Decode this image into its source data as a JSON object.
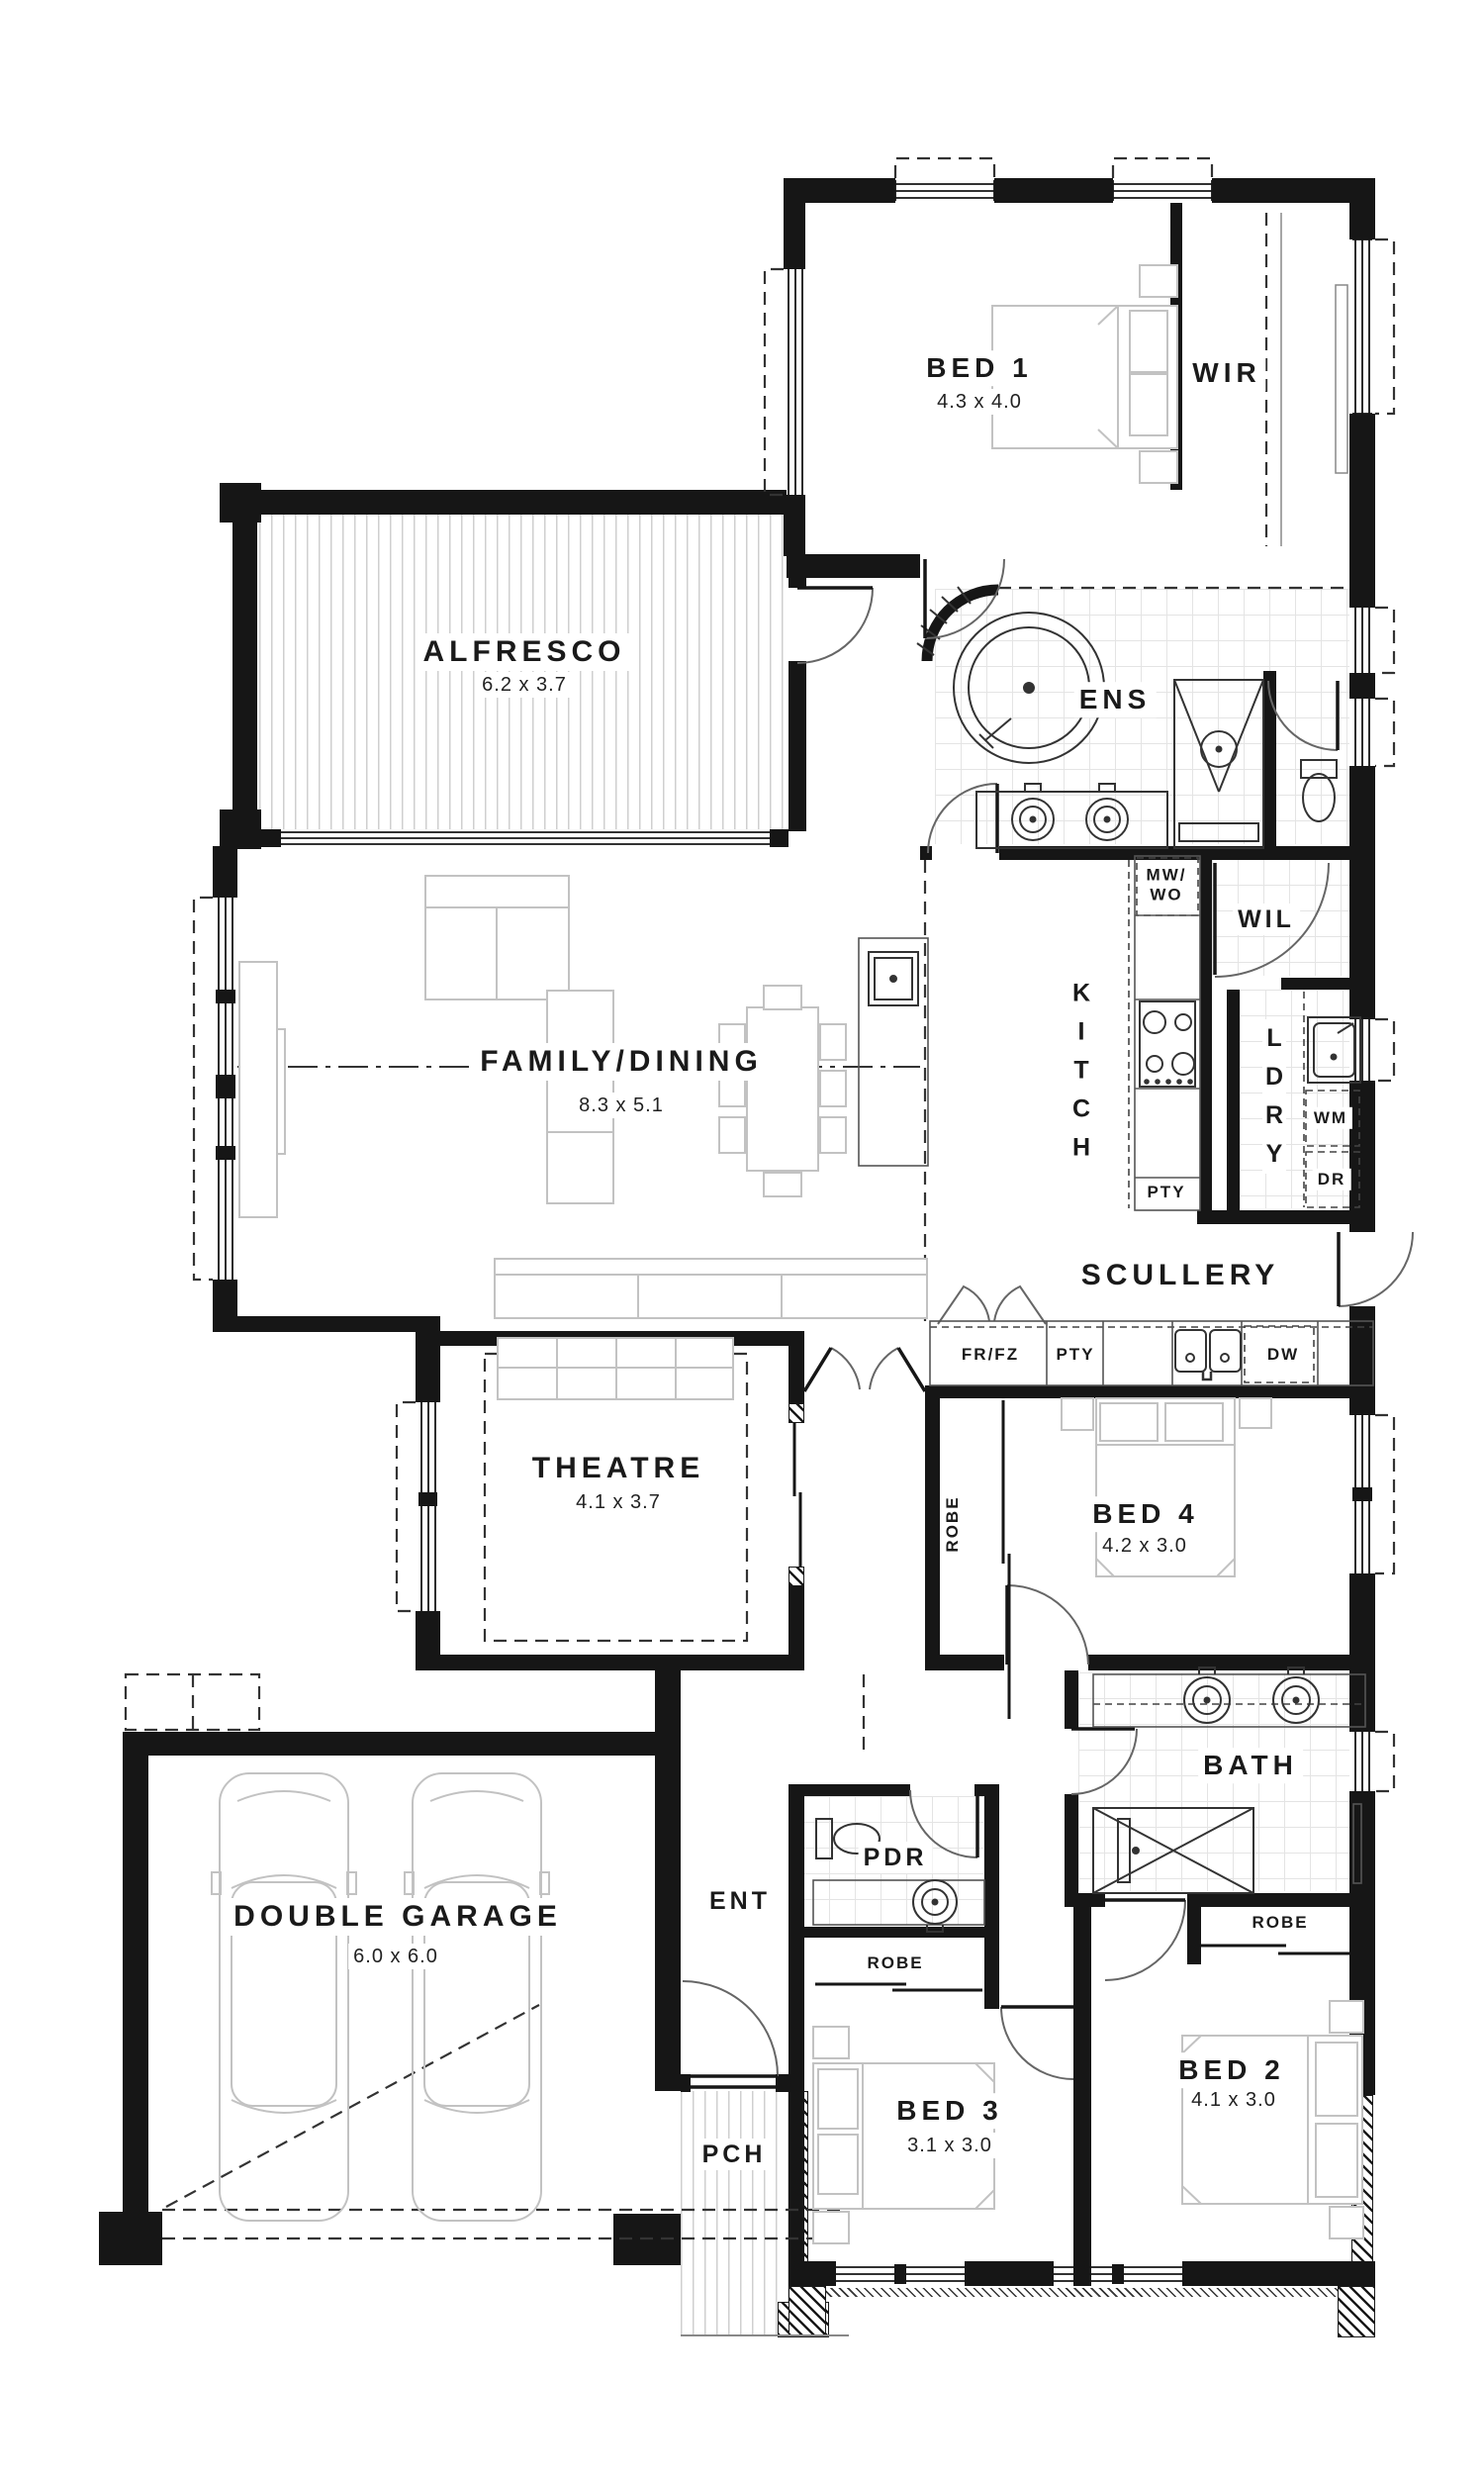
{
  "plan": {
    "rooms": {
      "bed1": {
        "name": "BED 1",
        "dims": "4.3 x 4.0"
      },
      "wir": {
        "name": "WIR"
      },
      "alfresco": {
        "name": "ALFRESCO",
        "dims": "6.2 x 3.7"
      },
      "ens": {
        "name": "ENS"
      },
      "family": {
        "name": "FAMILY/DINING",
        "dims": "8.3 x 5.1"
      },
      "kitchen": {
        "name": "K\nI\nT\nC\nH"
      },
      "wil": {
        "name": "WIL"
      },
      "laundry": {
        "name": "L\nD\nR\nY"
      },
      "scullery": {
        "name": "SCULLERY"
      },
      "theatre": {
        "name": "THEATRE",
        "dims": "4.1 x 3.7"
      },
      "bed4": {
        "name": "BED 4",
        "dims": "4.2 x 3.0"
      },
      "bath": {
        "name": "BATH"
      },
      "garage": {
        "name": "DOUBLE GARAGE",
        "dims": "6.0 x 6.0"
      },
      "entry": {
        "name": "ENT"
      },
      "powder": {
        "name": "PDR"
      },
      "bed3": {
        "name": "BED 3",
        "dims": "3.1 x 3.0"
      },
      "bed2": {
        "name": "BED 2",
        "dims": "4.1 x 3.0"
      },
      "porch": {
        "name": "PCH"
      }
    },
    "fixtures": {
      "mw_wo": "MW/\nWO",
      "pty_kitchen": "PTY",
      "wm": "WM",
      "dr": "DR",
      "fr_fz": "FR/FZ",
      "pty_scullery": "PTY",
      "dw": "DW",
      "robe_bed4": "ROBE",
      "robe_bed3": "ROBE",
      "robe_bed2": "ROBE"
    },
    "colors": {
      "wall": "#161616",
      "furniture": "#c2c2c2",
      "fixture": "#333333"
    }
  }
}
